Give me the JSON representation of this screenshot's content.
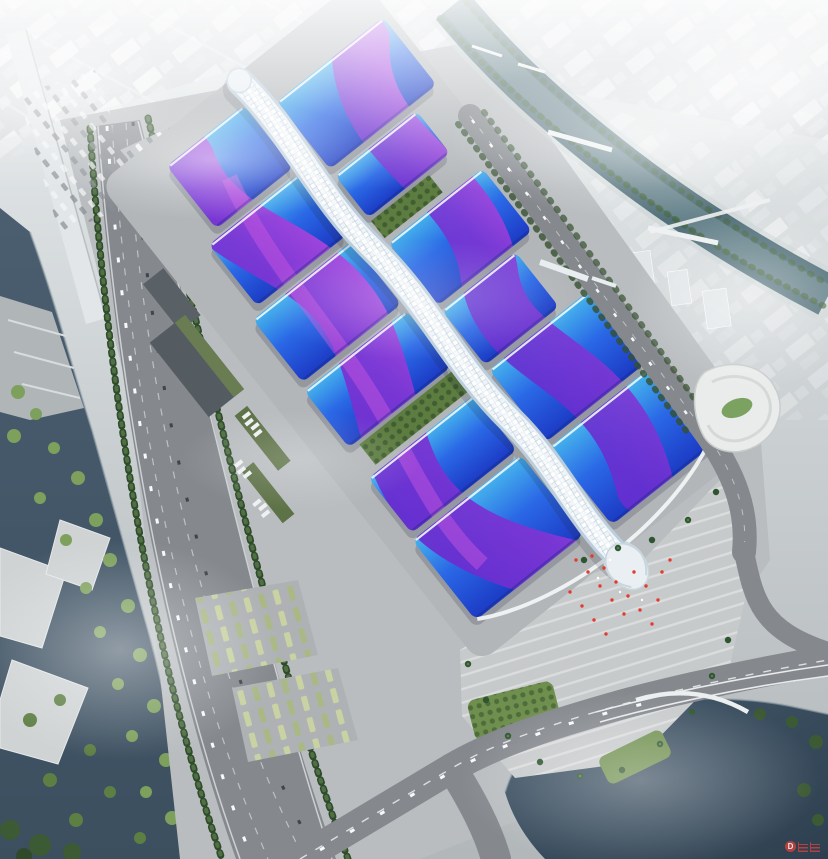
{
  "scene": {
    "subject": "exhibition-center-aerial-rendering",
    "complex": {
      "west_halls": 6,
      "east_halls": 6,
      "green_courtyards": 2,
      "central_spine": 1,
      "south_entrance_head": 1
    },
    "environment": [
      "hazy-city-skyline",
      "river-north-east",
      "canal-west",
      "lake-south-east",
      "parking-lots",
      "tree-lined-boulevard",
      "entrance-plaza-with-red-flags"
    ]
  },
  "colors": {
    "roofCyan": "#45b2ec",
    "roofBlue": "#2a68e6",
    "roofDeep": "#1c3ac4",
    "ribbonViolet": "#7d36d4",
    "ribbonMagenta": "#b44ae0",
    "spineWhite": "#edf3f7",
    "spineShade": "#bccddb",
    "riverTeal": "#52707a",
    "lakeDark": "#2e4050",
    "canalDark": "#3c4f5f",
    "landGrey": "#b9bdc0",
    "roadGrey": "#85898e",
    "plazaGrey": "#c7cacb",
    "treeDark": "#31492b",
    "treeLight": "#7da05c",
    "lawnGreen": "#6f8f4e",
    "warehouseGrey": "#535a5f",
    "hazeWhite": "#ffffff",
    "flagRed": "#e23c32",
    "watermarkRed": "#c9413c"
  },
  "watermark": {
    "letter": "D"
  }
}
